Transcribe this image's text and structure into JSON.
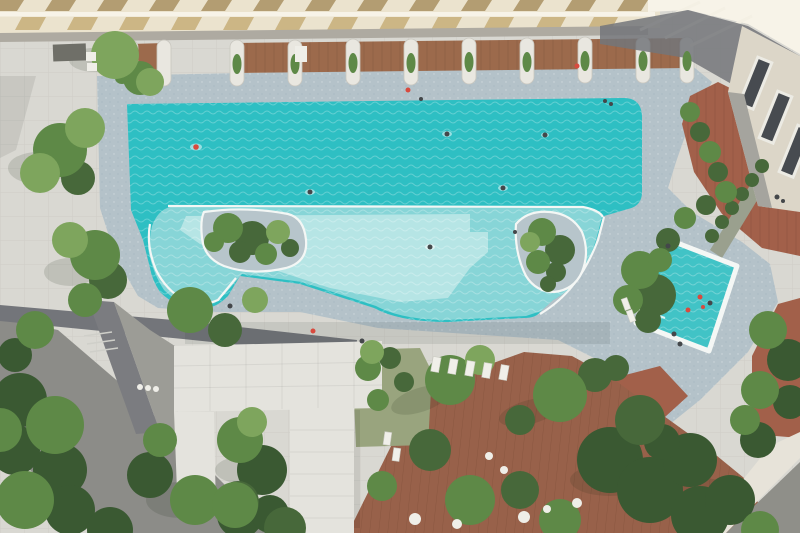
{
  "scene": {
    "title": "Aerial drone view of a condominium swimming pool complex with sawtooth roof, timber sun deck, gardens and children's pool"
  },
  "palette": {
    "plaza": "#d9d8d2",
    "road": "#8c8c88",
    "curb": "#dcdbd5",
    "walkway": "#73757a",
    "ramp": "#7b7c80",
    "wall": "#9c9c96",
    "deck": "#b4c2c9",
    "water": "#2ebfc3",
    "shallow": "#96d8da",
    "shallowLight": "#c2e8e9",
    "rim": "#f4f7f5",
    "kidsWater": "#41c3c6",
    "islandDeck": "#b7c5cb",
    "terracotta": "#a2604a",
    "wood": "#98614a",
    "lawn": "#99a47e",
    "canopy": "#e4e3dd",
    "roofCream": "#ebe3ce",
    "roofRidge": "#f7f3e8",
    "roofTanA": "#b39d72",
    "roofTanB": "#ccb685",
    "beam": "#aeaaa1",
    "band": "#9c6a4c",
    "divider": "#e9e7e0",
    "buildingFacade": "#dcd6c8",
    "buildingWall": "#a5a49e",
    "window": "#474b50",
    "windowFrame": "#ecebe4",
    "cornerWall": "#e7e3d9",
    "cornerInner": "#8f8f89",
    "planterBox": "#9aa08e",
    "treeLight": "#7ea55d",
    "treeMid": "#5e8947",
    "treeDark": "#47683a",
    "treeDeep": "#3a5932",
    "lounger": "#f0efe9",
    "mat": "#6f6f68",
    "whiteObj": "#efeee8",
    "personDark": "#44474a",
    "personRed": "#d84a3e"
  }
}
